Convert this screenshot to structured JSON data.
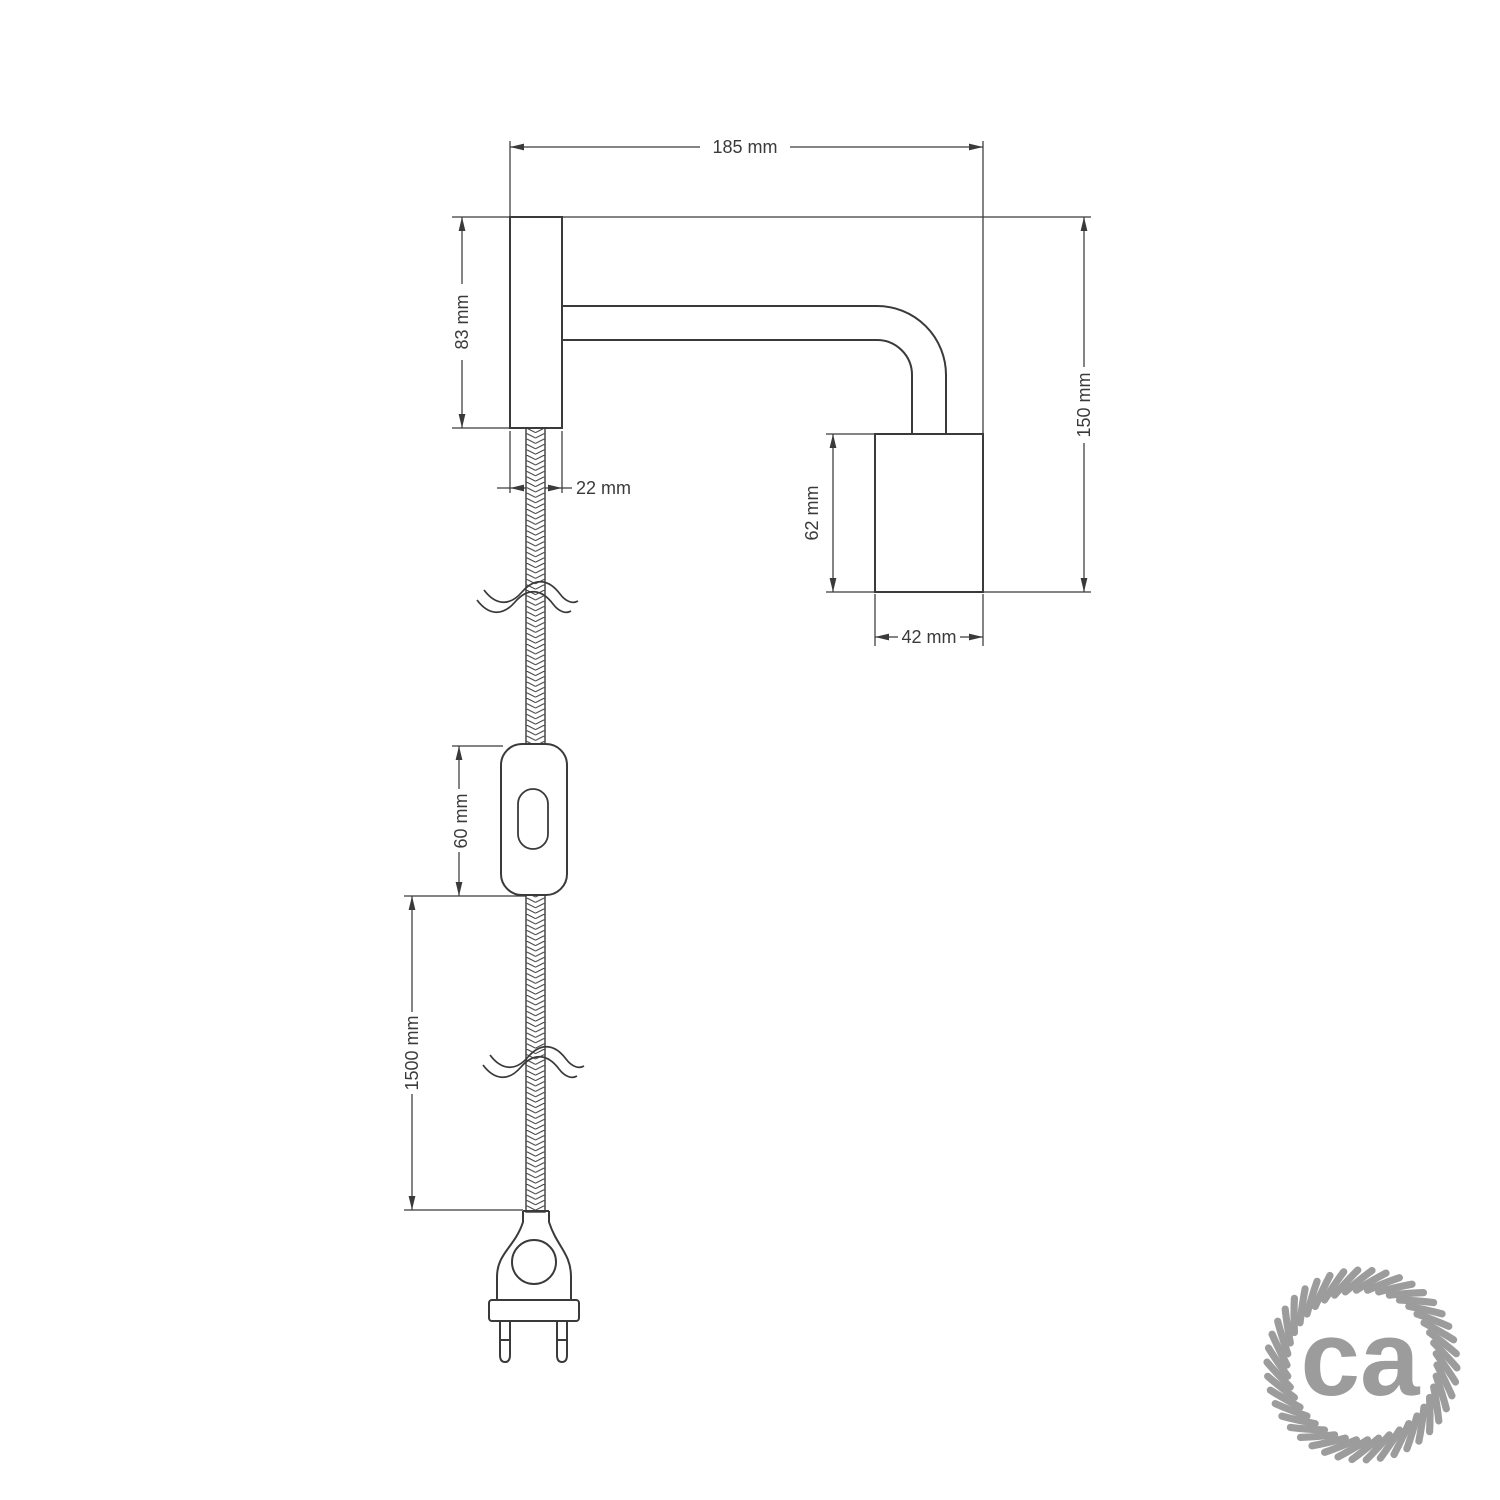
{
  "canvas": {
    "background": "#ffffff",
    "line_color": "#3a3a3a"
  },
  "diagram": {
    "dimensions": {
      "total_width": {
        "label": "185 mm"
      },
      "plate_height": {
        "label": "83 mm"
      },
      "plate_depth": {
        "label": "22 mm"
      },
      "total_height": {
        "label": "150 mm"
      },
      "socket_height": {
        "label": "62 mm"
      },
      "socket_width": {
        "label": "42 mm"
      },
      "switch_length": {
        "label": "60 mm"
      },
      "cable_length": {
        "label": "1500 mm"
      }
    }
  },
  "logo": {
    "text": "ca",
    "color": "#9c9c9c"
  }
}
